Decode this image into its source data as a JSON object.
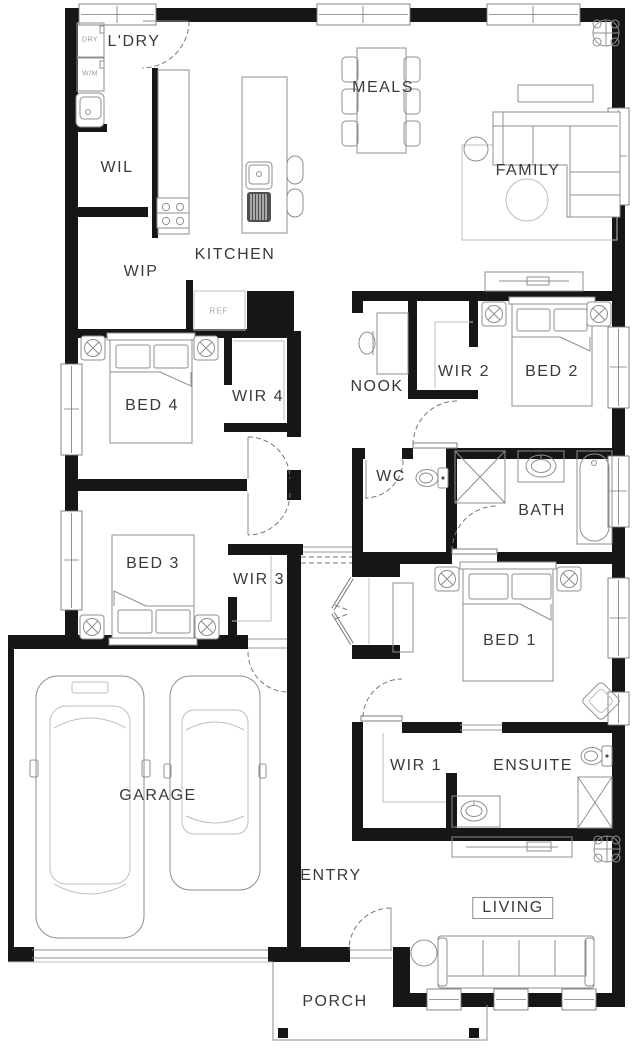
{
  "rooms": {
    "ldry": "L'DRY",
    "wil": "WIL",
    "wip": "WIP",
    "kitchen": "KITCHEN",
    "meals": "MEALS",
    "family": "FAMILY",
    "nook": "NOOK",
    "wir2": "WIR 2",
    "bed2": "BED 2",
    "bed4": "BED 4",
    "wir4": "WIR 4",
    "wc": "WC",
    "bath": "BATH",
    "bed3": "BED 3",
    "wir3": "WIR 3",
    "bed1": "BED 1",
    "garage": "GARAGE",
    "wir1": "WIR 1",
    "ensuite": "ENSUITE",
    "entry": "ENTRY",
    "living": "LIVING",
    "porch": "PORCH"
  },
  "appliances": {
    "dryer": "DRY",
    "washer": "W/M",
    "fridge": "REF"
  },
  "colors": {
    "wall": "#161616",
    "furniture": "#8f8f8f",
    "furniture_light": "#bdbdbd",
    "text": "#3a3a3a",
    "small_text": "#9b9b9b"
  }
}
